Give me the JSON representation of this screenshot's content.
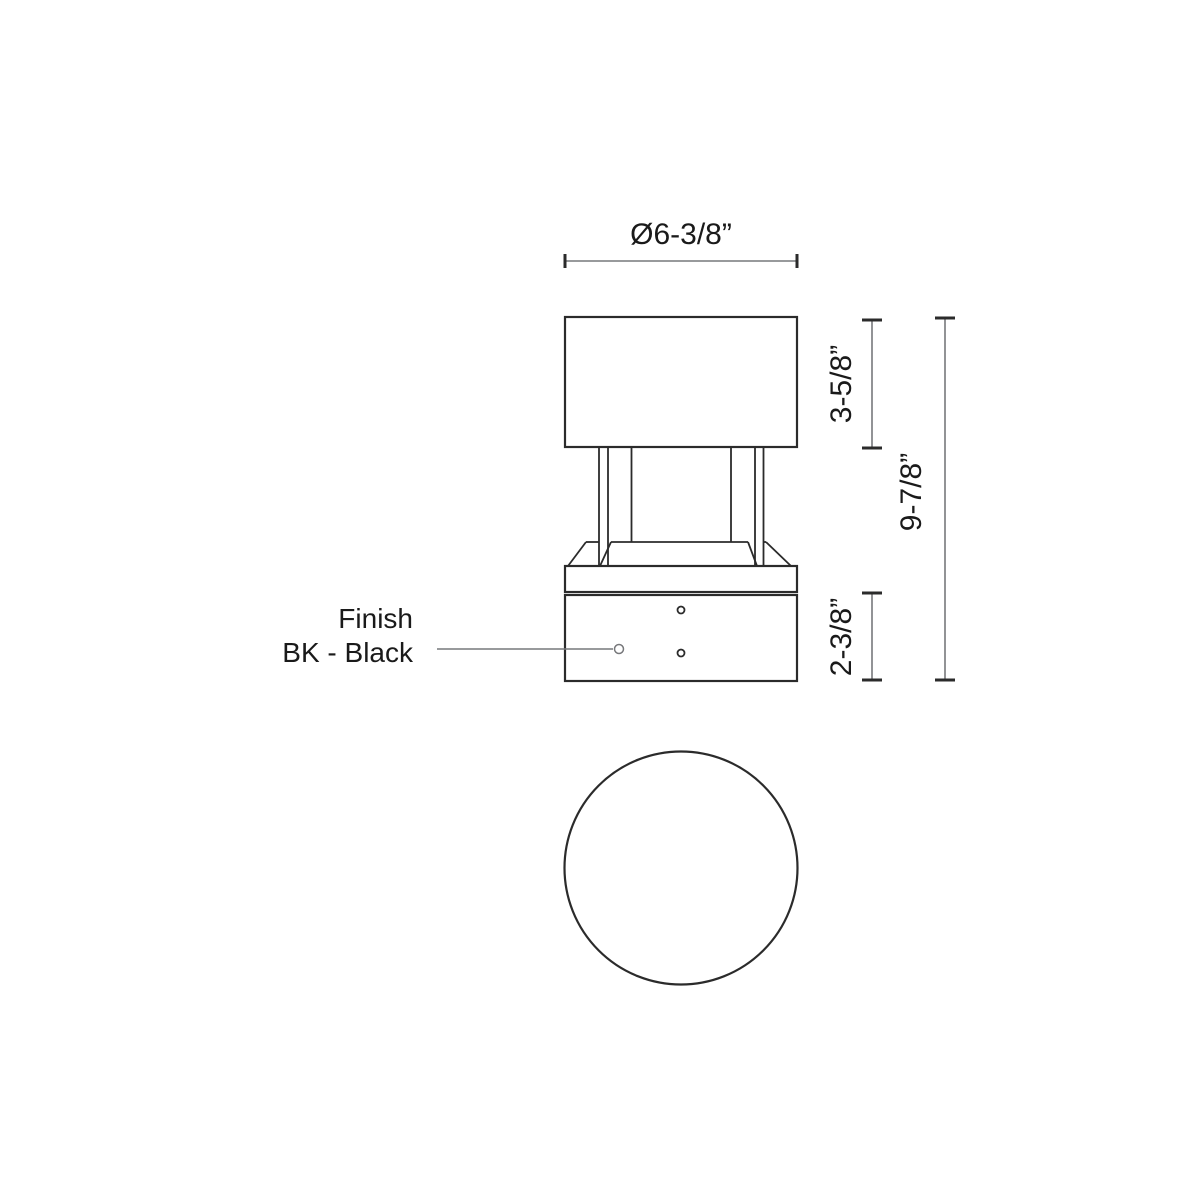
{
  "drawing": {
    "dims": {
      "diameter": "Ø6-3/8”",
      "shade_height": "3-5/8”",
      "overall_height": "9-7/8”",
      "base_height": "2-3/8”"
    },
    "finish": {
      "line1": "Finish",
      "line2": "BK - Black"
    },
    "colors": {
      "outline": "#2b2b2b",
      "dimension_line": "#77787b",
      "text": "#1a1a1a",
      "background": "#ffffff"
    }
  }
}
